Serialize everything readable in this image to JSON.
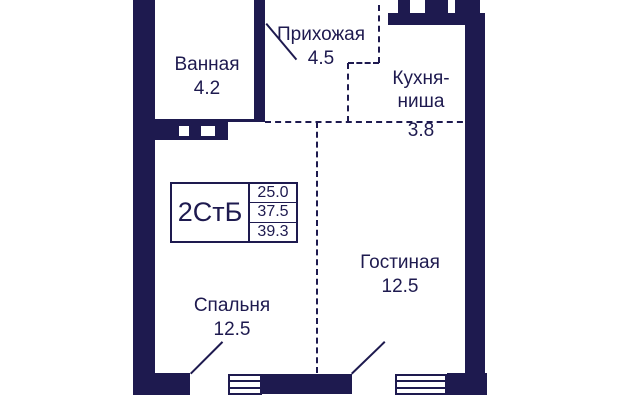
{
  "plan": {
    "title": "apartment-floor-plan",
    "colors": {
      "wall": "#1e1a4f",
      "background": "#ffffff"
    },
    "info_box": {
      "type_label": "2СтБ",
      "areas": {
        "living": "25.0",
        "total": "37.5",
        "total_with_balcony": "39.3"
      }
    },
    "rooms": [
      {
        "id": "bathroom",
        "name": "Ванная",
        "area": "4.2"
      },
      {
        "id": "hallway",
        "name": "Прихожая",
        "area": "4.5"
      },
      {
        "id": "kitchen",
        "name": "Кухня-\nниша",
        "area": "3.8"
      },
      {
        "id": "living",
        "name": "Гостиная",
        "area": "12.5"
      },
      {
        "id": "bedroom",
        "name": "Спальня",
        "area": "12.5"
      }
    ]
  }
}
